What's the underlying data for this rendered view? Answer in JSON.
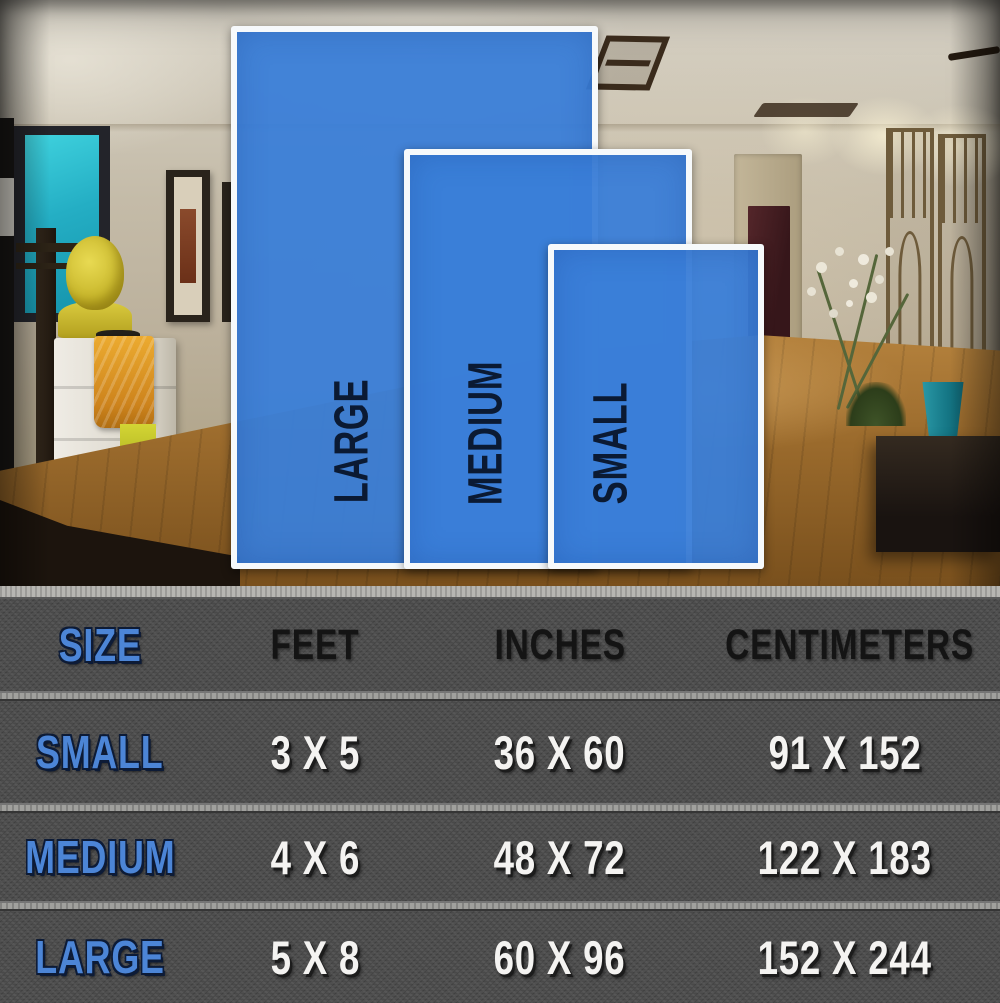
{
  "overlay": {
    "rugs": [
      {
        "name": "large",
        "label": "LARGE"
      },
      {
        "name": "medium",
        "label": "MEDIUM"
      },
      {
        "name": "small",
        "label": "SMALL"
      }
    ]
  },
  "chart_data": {
    "type": "table",
    "columns": [
      "SIZE",
      "FEET",
      "INCHES",
      "CENTIMETERS"
    ],
    "rows": [
      [
        "SMALL",
        "3 X 5",
        "36 X 60",
        "91 X 152"
      ],
      [
        "MEDIUM",
        "4 X 6",
        "48 X 72",
        "122 X 183"
      ],
      [
        "LARGE",
        "5 X 8",
        "60 X 96",
        "152 X 244"
      ]
    ]
  },
  "colors": {
    "rug_blue": "#3a7ed8",
    "rug_border_white": "#f6f9fb",
    "rug_label_navy": "#0b1a33",
    "table_background_gray": "#4f4f4f",
    "separator_gray": "#a0a09d",
    "size_column_blue": "#4c85d6",
    "value_white": "#f4f3f1",
    "header_black": "#141414"
  }
}
